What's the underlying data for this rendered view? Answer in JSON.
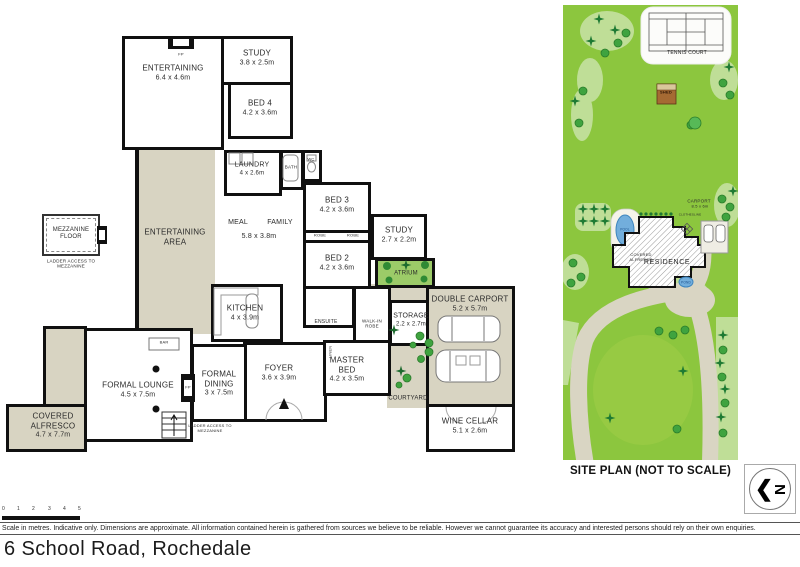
{
  "address": "6 School Road, Rochedale",
  "compass_letter": "N",
  "floor_plan": {
    "rooms": {
      "entertaining": {
        "label": "ENTERTAINING",
        "dims": "6.4 x 4.6m"
      },
      "study_top": {
        "label": "STUDY",
        "dims": "3.8 x 2.5m"
      },
      "bed4": {
        "label": "BED 4",
        "dims": "4.2 x 3.6m"
      },
      "laundry": {
        "label": "LAUNDRY",
        "dims": "4 x 2.6m"
      },
      "bed3": {
        "label": "BED 3",
        "dims": "4.2 x 3.6m"
      },
      "study_mid": {
        "label": "STUDY",
        "dims": "2.7 x 2.2m"
      },
      "bed2": {
        "label": "BED 2",
        "dims": "4.2 x 3.6m"
      },
      "kitchen": {
        "label": "KITCHEN",
        "dims": "4 x 3.9m"
      },
      "storage": {
        "label": "STORAGE",
        "dims": "2.2 x 2.7m"
      },
      "foyer": {
        "label": "FOYER",
        "dims": "3.6 x 3.9m"
      },
      "master": {
        "label": "MASTER BED",
        "dims": "4.2 x 3.5m"
      },
      "formal_dining": {
        "label": "FORMAL DINING",
        "dims": "3 x 7.5m"
      },
      "formal_lounge": {
        "label": "FORMAL LOUNGE",
        "dims": "4.5 x 7.5m"
      },
      "covered_alfresco": {
        "label": "COVERED ALFRESCO",
        "dims": "4.7 x 7.7m"
      },
      "double_carport": {
        "label": "DOUBLE CARPORT",
        "dims": "5.2 x 5.7m"
      },
      "wine_cellar": {
        "label": "WINE CELLAR",
        "dims": "5.1 x 2.6m"
      }
    },
    "misc": {
      "meal": "MEAL",
      "family": "FAMILY",
      "meal_family_dims": "5.8 x 3.8m",
      "entertaining_area": "ENTERTAINING AREA",
      "mezzanine": "MEZZANINE FLOOR",
      "ladder_note": "LADDER ACCESS TO MEZZANINE",
      "atrium": "ATRIUM",
      "courtyard": "COURTYARD",
      "ensuite": "ENSUITE",
      "walk_in_robe": "WALK-IN ROBE",
      "robe": "ROBE",
      "bath": "BATH",
      "wc": "WC",
      "bar": "BAR",
      "fp": "FP",
      "linen": "LINEN"
    }
  },
  "site_plan": {
    "title": "SITE PLAN (NOT TO SCALE)",
    "labels": {
      "tennis_court": "TENNIS COURT",
      "shed": "SHED",
      "residence": "RESIDENCE",
      "carport": "CARPORT",
      "carport_dims": "8.5 x 6m",
      "clothesline": "CLOTHESLINE",
      "pool": "POOL",
      "pond": "POND",
      "covered_alfresco": "COVERED ALFRESCO"
    }
  },
  "footer": {
    "scale_ticks": [
      "0",
      "1",
      "2",
      "3",
      "4",
      "5"
    ],
    "disclaimer": "Scale in metres. Indicative only. Dimensions are approximate. All information contained herein is gathered from sources we believe to be reliable. However we cannot guarantee its accuracy and interested persons should rely on their own enquiries."
  },
  "colors": {
    "wall": "#101010",
    "outdoor_tan": "#d8d4c2",
    "lawn": "#8cc63e",
    "lawn_light": "#bfde97",
    "tree_green": "#3fa33f",
    "star_tree_green": "#1e7a33",
    "atrium_green": "#9ccb68",
    "pool_blue": "#72aedc",
    "driveway": "#d9d5c3",
    "shed_brown": "#a56a33"
  }
}
